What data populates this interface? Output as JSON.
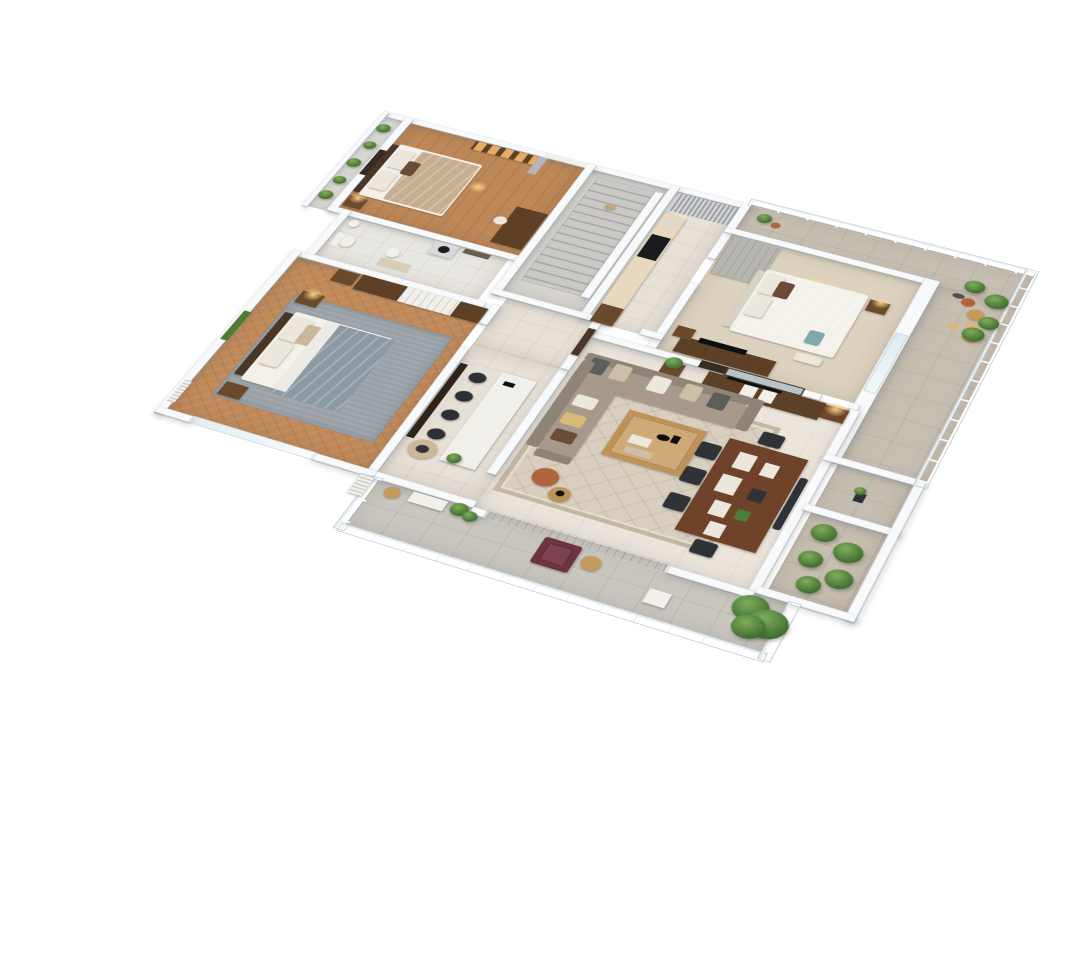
{
  "scene": {
    "type": "3d-floor-plan-render",
    "description": "Isometric cutaway 3D render of a three-bedroom apartment with wrap-around terrace and long balcony",
    "view": "aerial isometric, rotated clockwise, white background",
    "background": "#ffffff"
  },
  "palette": {
    "background": "#ffffff",
    "wall": "#f8f9fa",
    "wood_floor": "#bd8757",
    "herringbone_floor": "#c08a5a",
    "stair_floor": "#d7d5d1",
    "tile_floor": "#e6e0d7",
    "bath_floor": "#e9e7e1",
    "carpet": "#ddd1bf",
    "living_floor": "#ebe5dc",
    "terrace_tile": "#c7beb2",
    "balcony_tile": "#c9c6c0",
    "planter_tile": "#dfe0dc",
    "rug_gray": "#9aa2a8",
    "rug_cream": "#d8cfbf",
    "bath_mat": "#d8cdb9",
    "wood_dark": "#5d4026",
    "wood_mid": "#6b4a2c",
    "wood_light": "#bf9257",
    "walnut": "#6f432a",
    "headboard_dark": "#4a3626",
    "headboard_pale": "#d8d2c6",
    "white_fabric": "#f4f1ea",
    "beige_fabric": "#c7ae93",
    "gray_duvet": "#8b99a2",
    "sheet_white": "#eceae4",
    "sofa": "#a79a8d",
    "sofa_back": "#8f8478",
    "cushion_dark": "#5c5f58",
    "cushion_pattern": "#cbbfa8",
    "cushion_white": "#ece7dd",
    "cushion_brown": "#6b4c38",
    "chair_dark": "#2f3237",
    "stool_dark": "#2c2f33",
    "armchair_beige": "#cbb79b",
    "maroon_chair": "#6d3340",
    "plant_green": "#4e7b36",
    "terracotta": "#b0643c",
    "gold_lamp": "#caa96a",
    "curtain_gray": "#b4b6ba",
    "wardrobe_gray": "#b7b5b0",
    "appliance_black": "#1a1b1d",
    "washer_white": "#d7d9da",
    "teal_pillow": "#7fa9ac",
    "mustard": "#d9b878",
    "tan_hat": "#c59a5f",
    "white_paint": "#f1efe9",
    "frame_dark": "#352c22",
    "art_sea": "#b9c3c6",
    "art_olive": "#6a5d4a",
    "counter_cream": "#e8d8bd",
    "drain_gray": "#4a4f52",
    "tv_black": "#0e0f11",
    "panel_black": "#2e241a",
    "step_ball": "#c2a47c"
  },
  "rooms": [
    {
      "name": "bedroom-top",
      "floor": "wood planks",
      "furniture": [
        "double-bed-beige",
        "headboard",
        "two-white-pillows",
        "accent-pillow",
        "nightstand",
        "table-lamp",
        "wall-art",
        "recessed-lit-shelving",
        "window-white-curtain",
        "dark-wood-desk",
        "chair"
      ]
    },
    {
      "name": "planter-balcony",
      "floor": "light tile",
      "furniture": [
        "row-of-small-plants"
      ]
    },
    {
      "name": "bathroom",
      "floor": "ceramic tile",
      "furniture": [
        "toilet",
        "bidet",
        "pedestal-sink",
        "washing-machine",
        "wall-art",
        "bath-mat"
      ]
    },
    {
      "name": "master-bedroom",
      "floor": "herringbone wood",
      "furniture": [
        "wardrobe-brown-white",
        "dresser",
        "double-bed-gray-duvet",
        "dark-headboard",
        "white-pillows",
        "beige-pillow",
        "two-nightstands",
        "gold-lamp",
        "wall-art-green",
        "gray-rug",
        "radiator",
        "sliding-glass-door"
      ]
    },
    {
      "name": "staircase-hall",
      "floor": "concrete gray",
      "furniture": [
        "stair-flight",
        "balustrade-wall",
        "decor-ball"
      ]
    },
    {
      "name": "kitchen-corridor",
      "floor": "ceramic tile",
      "furniture": [
        "gray-curtain",
        "cream-counter",
        "black-cooktop",
        "sink",
        "wood-cabinet"
      ]
    },
    {
      "name": "bedroom-right",
      "floor": "beige carpet",
      "furniture": [
        "gray-wardrobe",
        "pendant-light",
        "double-bed-white",
        "pale-headboard",
        "white-pillows",
        "brown-pillow",
        "teal-pillow",
        "bench",
        "nightstand-gold-lamp",
        "media-console",
        "tv",
        "wall-art",
        "side-table",
        "window"
      ]
    },
    {
      "name": "terrace",
      "floor": "warm gray tile",
      "furniture": [
        "glass-railing",
        "potted-plant-cluster",
        "terracotta-pots",
        "yellow-pots",
        "floor-drain",
        "straw-hat"
      ]
    },
    {
      "name": "right-balcony-garden",
      "floor": "warm gray tile",
      "furniture": [
        "watering-can",
        "green-shrubs",
        "partition-wall"
      ]
    },
    {
      "name": "living-room",
      "floor": "cream tile",
      "furniture": [
        "l-shaped-sofa",
        "six-cushions",
        "wood-coffee-table",
        "books",
        "black-decor",
        "patterned-rug",
        "sideboard-dark-wood",
        "tv",
        "seascape-art",
        "plant-side-table",
        "gold-lamp-table",
        "terracotta-pouf",
        "round-side-table",
        "dark-entry-door",
        "sliding-glass-doors"
      ]
    },
    {
      "name": "dining-area",
      "floor": "cream tile",
      "furniture": [
        "walnut-dining-table",
        "five-dark-chairs",
        "bench",
        "white-placemats",
        "dark-trays",
        "green-dish"
      ]
    },
    {
      "name": "kitchen-nook",
      "floor": "ceramic tile",
      "furniture": [
        "dark-wall-panel",
        "white-island-counter",
        "four-dark-stools",
        "beige-armchair",
        "island-plant"
      ]
    },
    {
      "name": "bottom-balcony",
      "floor": "gray tile",
      "furniture": [
        "glass-railing",
        "maroon-armchair",
        "palm-plant",
        "white-side-table",
        "white-bench",
        "planter-greens",
        "straw-hat",
        "ac-unit"
      ]
    }
  ]
}
